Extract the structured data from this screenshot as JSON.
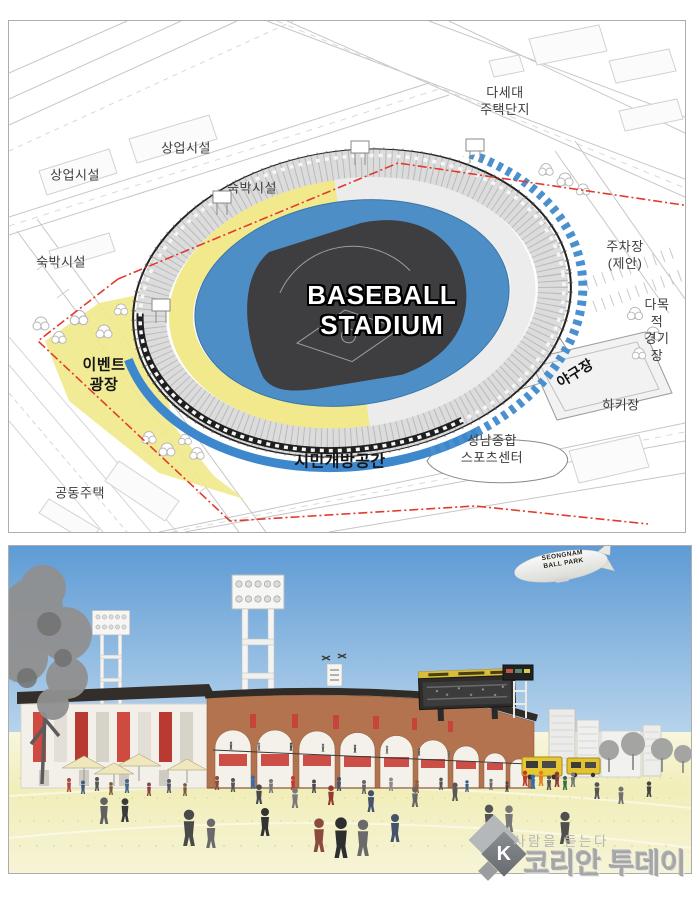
{
  "site_plan": {
    "labels": {
      "commercial_top": "상업시설",
      "commercial_left": "상업시설",
      "lodging_top": "숙박시설",
      "lodging_left": "숙박시설",
      "multi_family_housing": "다세대\n주택단지",
      "parking_proposed": "주차장\n(제안)",
      "multipurpose_field": "다목적\n경기장",
      "hockey_field": "하키장",
      "baseball_field": "야구장",
      "sports_center": "성남종합\n스포츠센터",
      "open_space": "시민개방공간",
      "event_plaza": "이벤트\n광장",
      "apartments": "공동주택",
      "stadium_title": "BASEBALL\nSTADIUM"
    },
    "colors": {
      "event_plaza_fill": "#f1e98c",
      "open_space_line": "#3d87cc",
      "site_boundary_line": "#e23a2e",
      "seating_bowl": "#4e8ec6",
      "field": "#3e3e40"
    }
  },
  "rendering": {
    "blimp_text": "SEONGNAM\nBALL PARK",
    "sky_color": "#5e9bd5",
    "ground_color": "#f1eeb9",
    "brick_color": "#b3734e"
  },
  "watermark": {
    "slogan": "사람을 듣는다",
    "brand": "코리안 투데이",
    "logo_letter": "K"
  }
}
